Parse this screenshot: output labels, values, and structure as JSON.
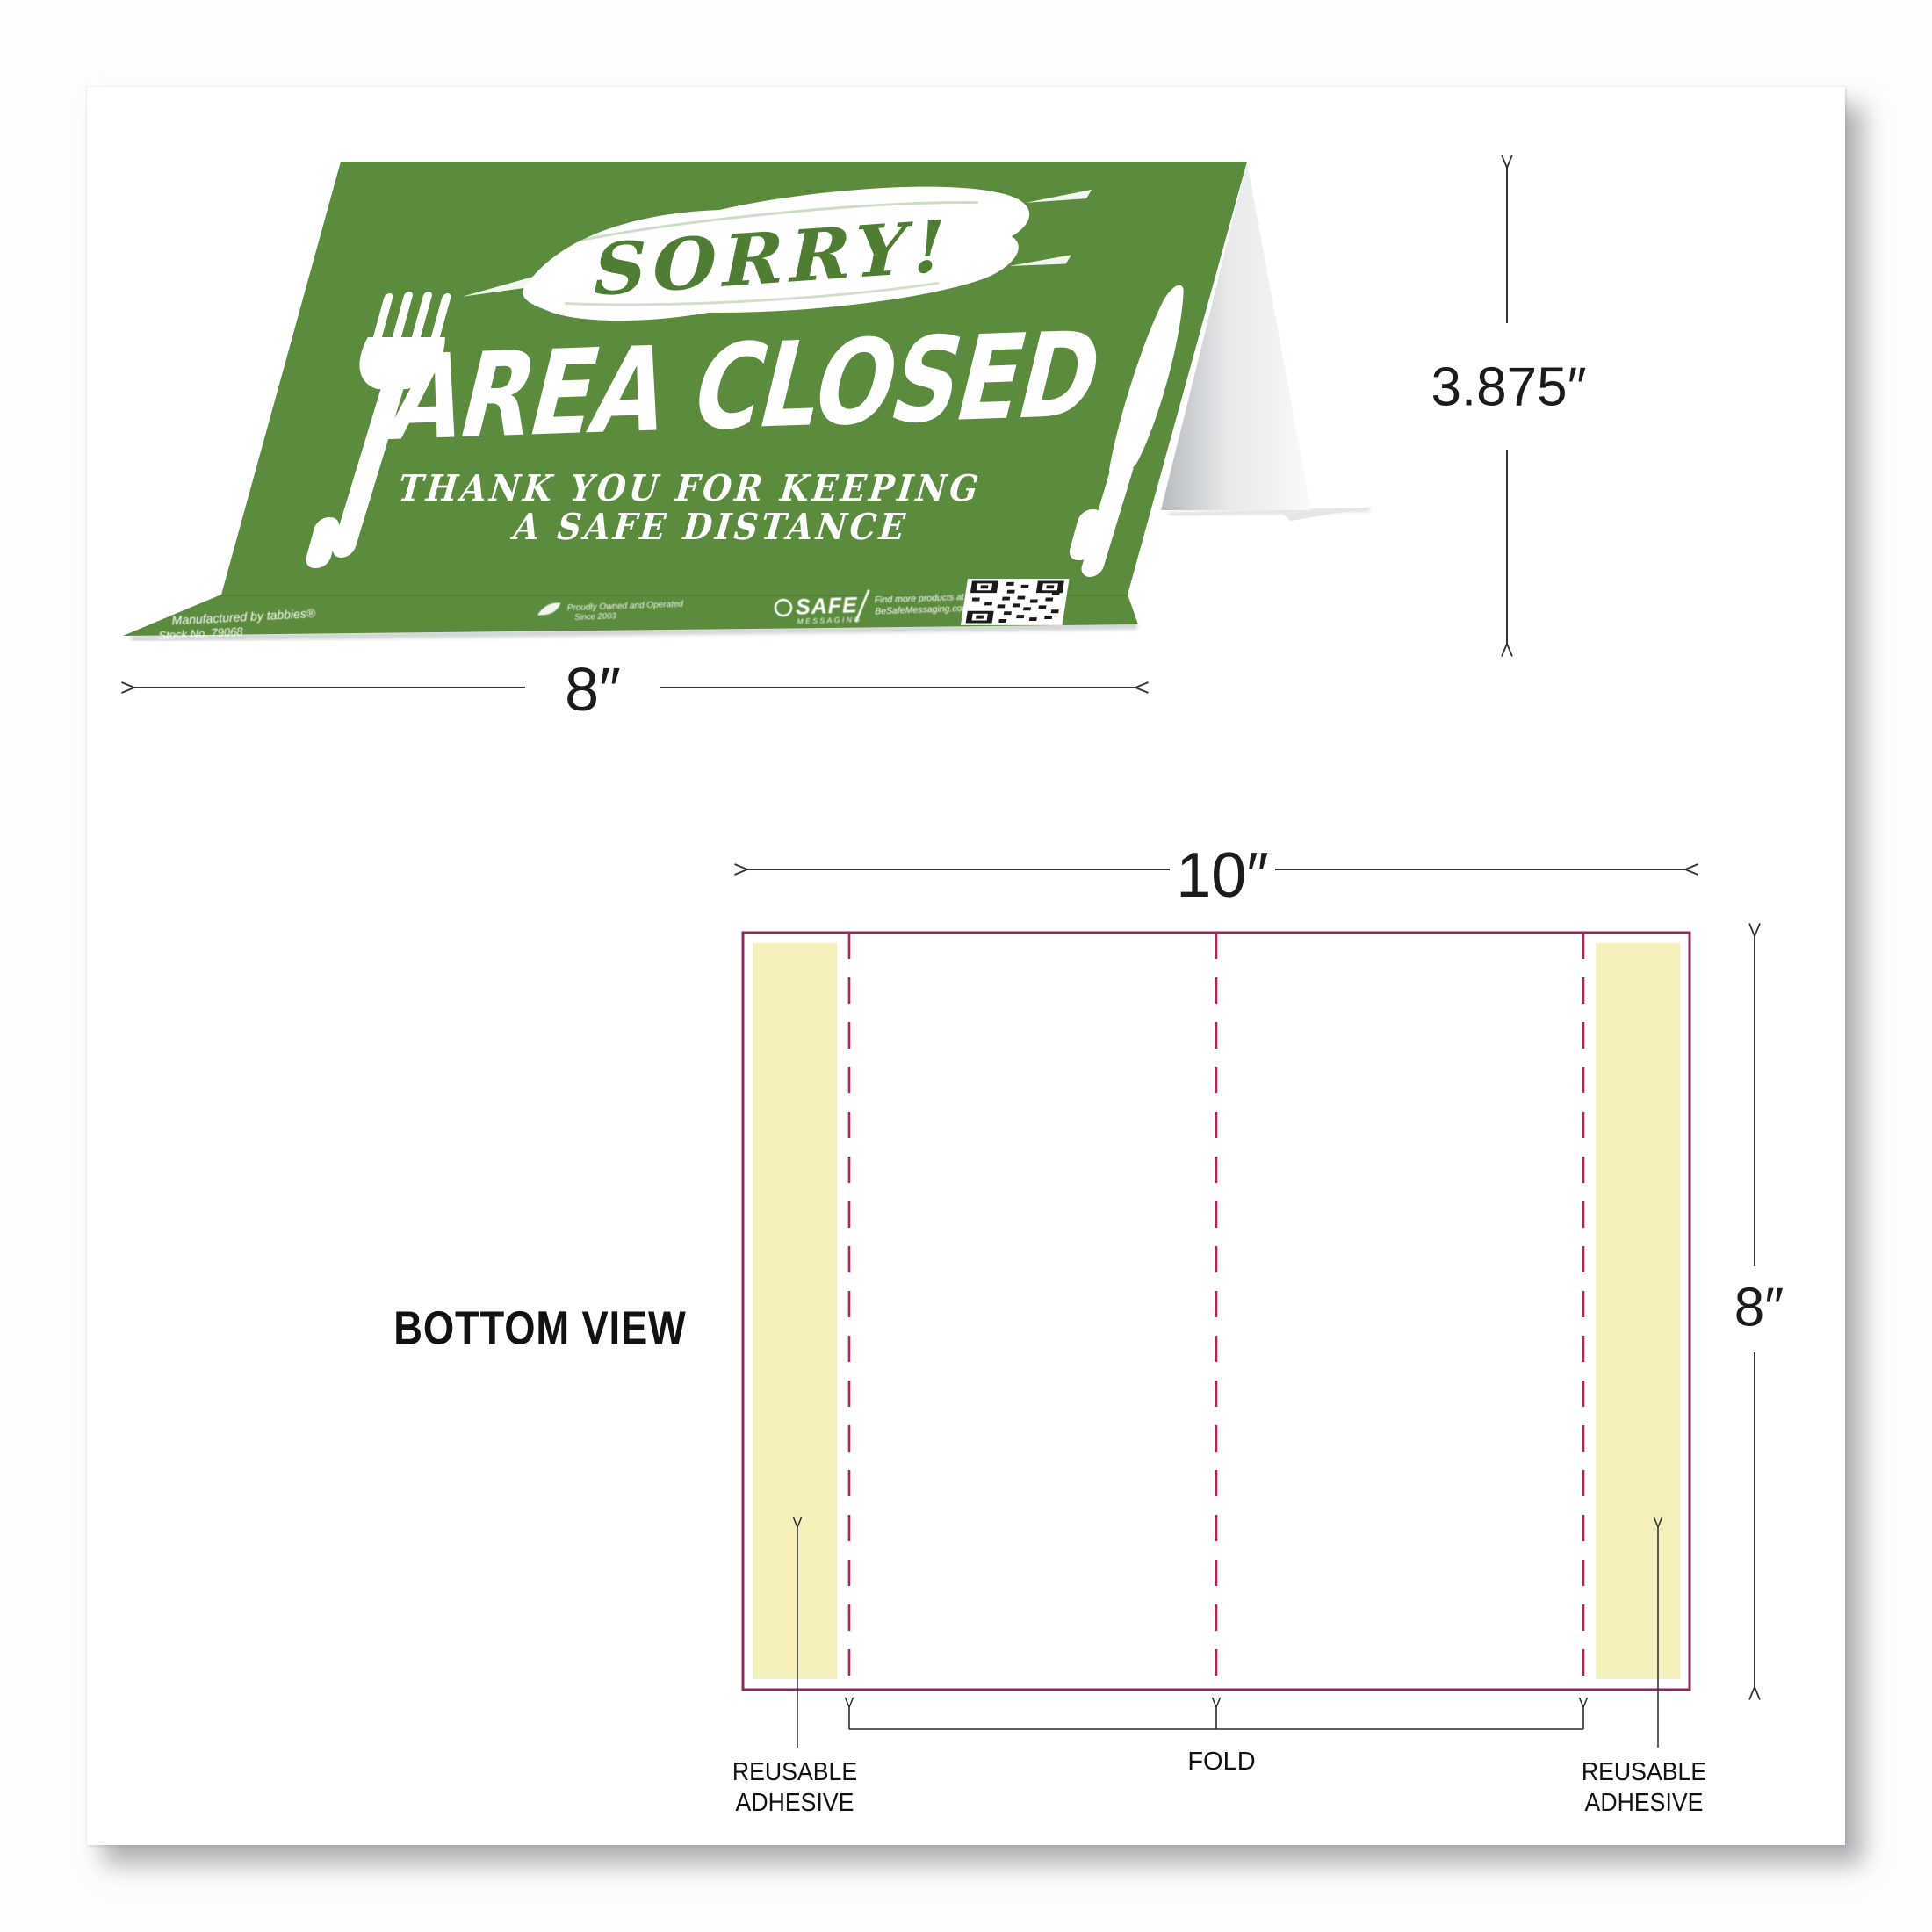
{
  "tent_sign": {
    "sorry_text": "SORRY!",
    "headline": "AREA CLOSED",
    "subline_1": "THANK YOU FOR KEEPING",
    "subline_2": "A SAFE DISTANCE",
    "height_dimension": "3.875″",
    "width_dimension": "8″",
    "flap": {
      "manufacturer": "Manufactured by tabbies®",
      "stock_no": "Stock No. 79068",
      "center_note_1": "Proudly Owned and Operated",
      "center_note_2": "Since 2003",
      "brand": "SAFE",
      "brand_sub": "MESSAGING",
      "promo_1": "Find more products at",
      "promo_2": "BeSafeMessaging.com"
    }
  },
  "bottom_view": {
    "title": "BOTTOM VIEW",
    "width_dimension": "10″",
    "height_dimension": "8″",
    "fold_label": "FOLD",
    "left_adhesive_label_1": "REUSABLE",
    "left_adhesive_label_2": "ADHESIVE",
    "right_adhesive_label_1": "REUSABLE",
    "right_adhesive_label_2": "ADHESIVE"
  },
  "colors": {
    "tent_green": "#5b8b3d",
    "tent_green_dark": "#4a7431",
    "sorry_green": "#4e7d33",
    "plate_border": "#8c2a5e",
    "fold_dash": "#b81f5f",
    "adhesive_yellow": "#f5efbc",
    "dim_line": "#333333"
  }
}
